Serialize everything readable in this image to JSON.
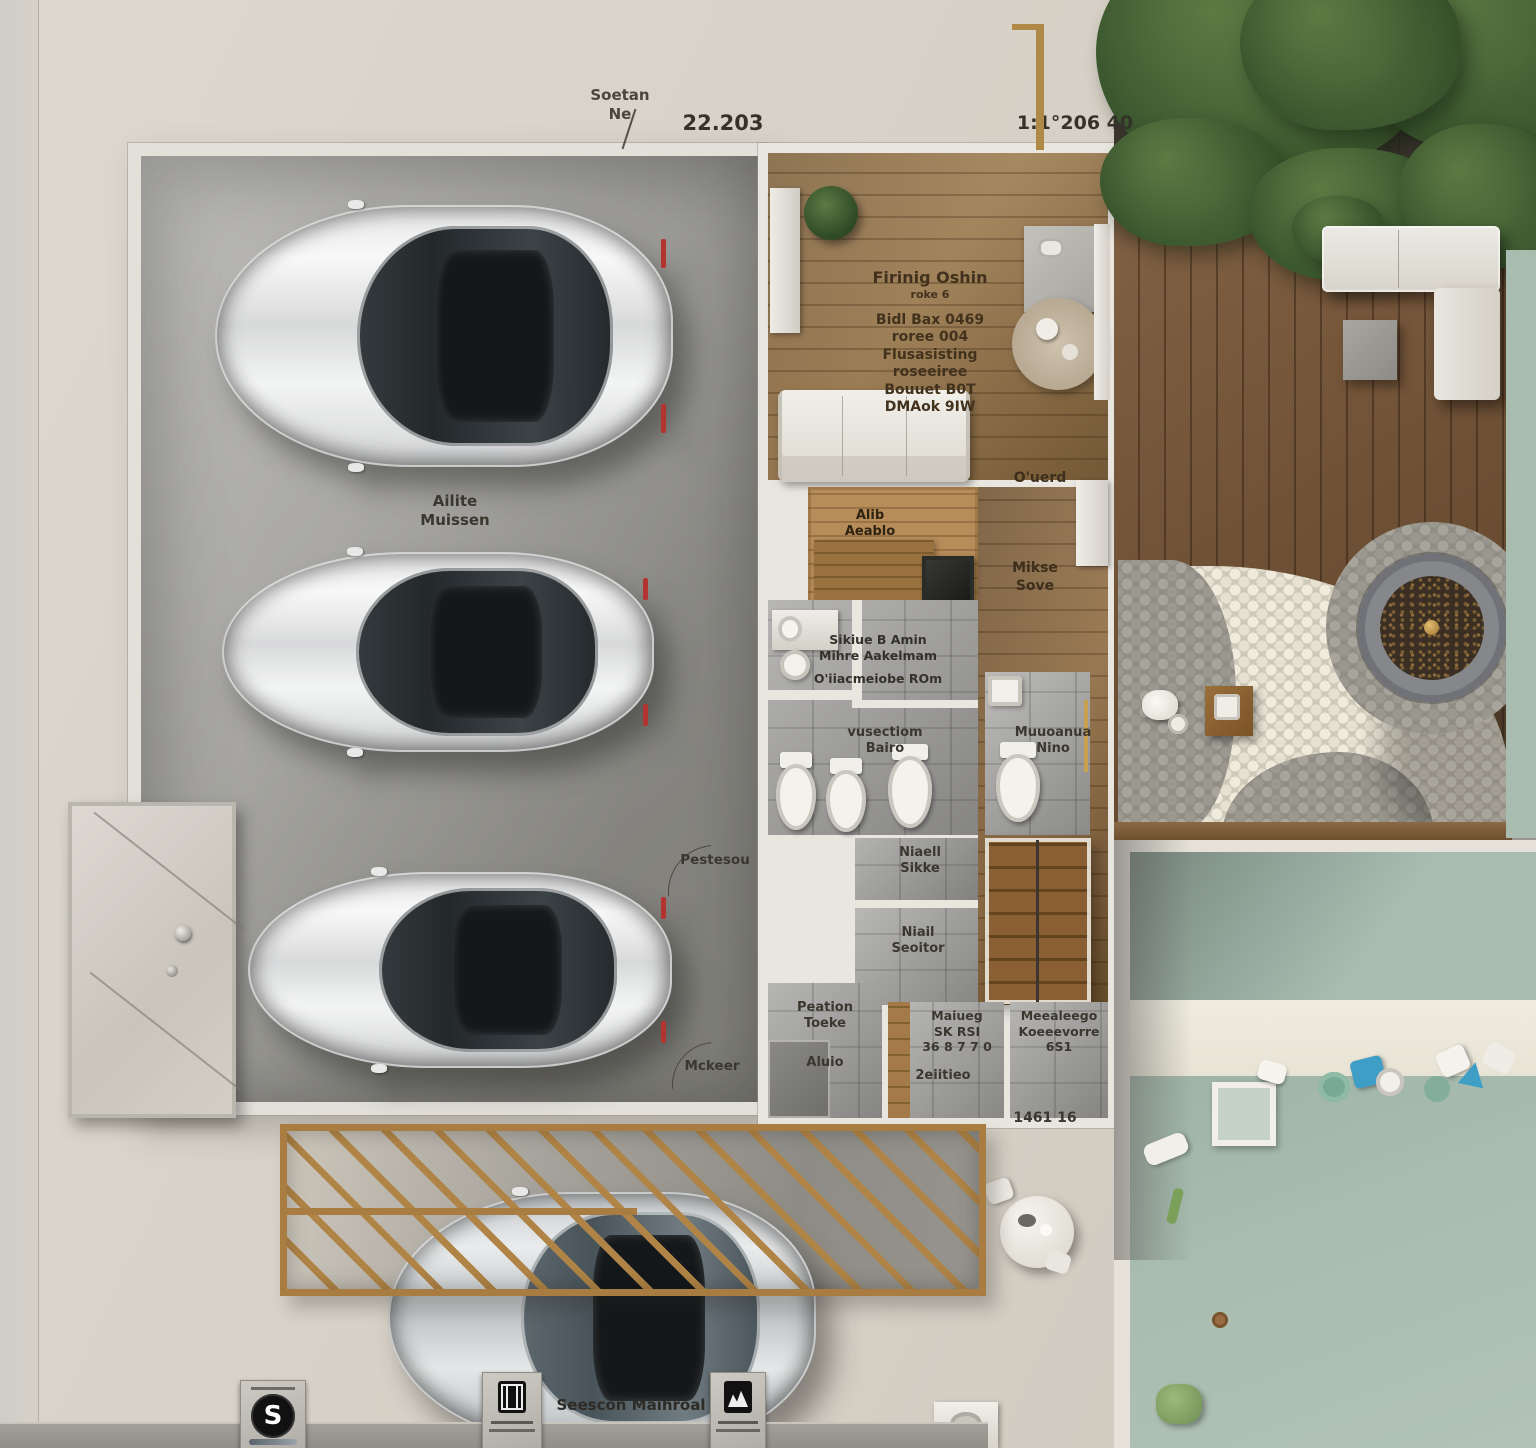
{
  "annotations": {
    "site_line1": "Soetan",
    "site_line2": "Ne",
    "dim_top": "22.203",
    "dim_top_right": "1:1°206 40",
    "dim_bottom_right": "1461 16",
    "bottom_caption": "Seescon Maihroal",
    "door_upper": "Pestesou",
    "door_lower": "Mckeer",
    "sign_s": "S"
  },
  "rooms": {
    "garage": {
      "line1": "Ailite",
      "line2": "Muissen"
    },
    "living": {
      "title": "Firinig Oshin",
      "subtitle": "roke 6",
      "lines": [
        "Bidl Bax 0469",
        "roree 004",
        "Flusasisting",
        "roseeiree",
        "Bouuet B0T",
        "DMAok 9IW"
      ]
    },
    "hall_top": "O'uerd",
    "sauna": {
      "line1": "Alib",
      "line2": "Aeablo"
    },
    "hall_mid": {
      "line1": "Mikse",
      "line2": "Sove"
    },
    "bath": {
      "line1": "Sikiue B Amin",
      "line2": "Mihre Aakelmam",
      "line3": "O'iiacmeiobe ROm"
    },
    "shower": {
      "line1": "vusectiom",
      "line2": "Bairo"
    },
    "wc": {
      "line1": "Muuoanua",
      "line2": "Nino"
    },
    "hall_lower": {
      "line1": "Niaell",
      "line2": "Sikke"
    },
    "hall_bottom": {
      "line1": "Niail",
      "line2": "Seoitor"
    },
    "storage": {
      "line1": "Peation",
      "line2": "Toeke",
      "line3": "Aluio"
    },
    "laundry": {
      "line1": "Maiueg",
      "line2": "SK RSI",
      "line3": "36 8 7 7 0",
      "line4": "2eiitieo"
    },
    "pantry": {
      "line1": "Meealeego",
      "line2": "Koeeevorre",
      "line3": "6S1"
    }
  },
  "icons": {
    "sign_circle": "s-sign-icon",
    "plaque_left": "gate-plaque-icon",
    "plaque_right": "facility-plaque-icon"
  },
  "colors": {
    "ground": "#d8d2c9",
    "garage_floor": "#a8a7a3",
    "wall": "#e9e6e0",
    "wood_floor": "#a5804f",
    "deck_wood": "#7c5735",
    "pergola_wood": "#b08446",
    "pool_water": "#a9bcb0",
    "tile": "#a3a2a0",
    "tree": "#3f5b35",
    "accent_red": "#b23430",
    "accent_gold": "#c9a04e"
  }
}
